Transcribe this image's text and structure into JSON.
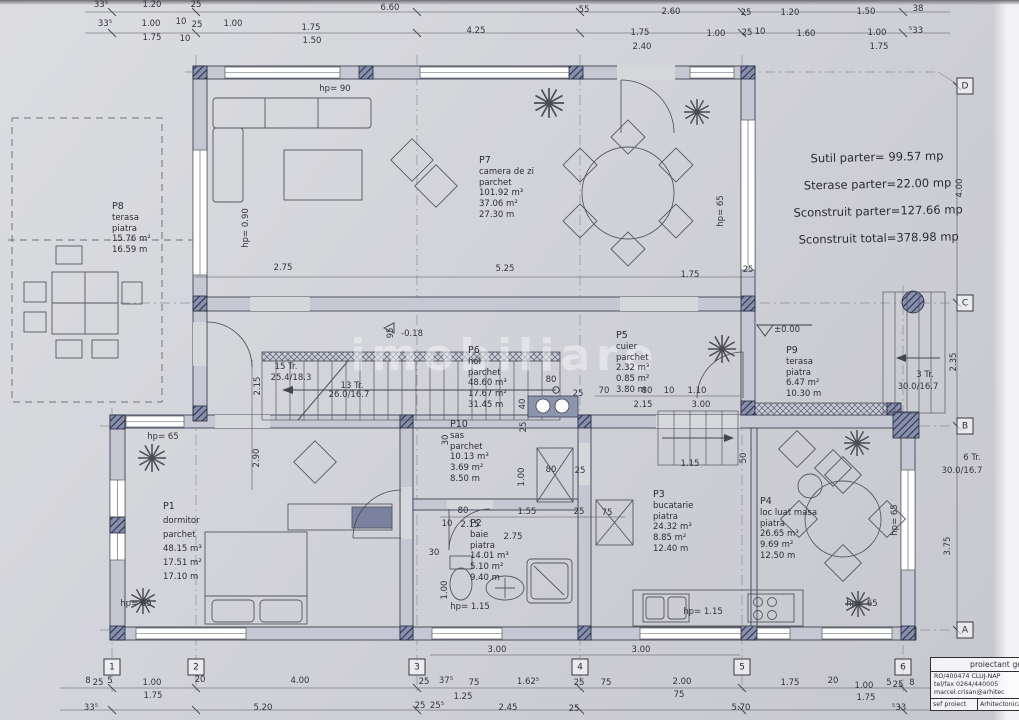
{
  "sheet": {
    "watermark": "imobiliare",
    "summary": [
      "Sutil parter= 99.57 mp",
      "Sterase parter=22.00 mp",
      "Sconstruit parter=127.66 mp",
      "Sconstruit total=378.98 mp"
    ],
    "title_block": {
      "header": "proiectant general",
      "line1": "RO/400474 CLUJ-NAP",
      "line2": "tel/fax 0264/440005",
      "line3": "marcel.crisan@arhitec",
      "row_label": "sef proiect",
      "row_value": "Arhitectonica"
    }
  },
  "rooms": [
    {
      "id": "P7",
      "name": "camera de zi",
      "finish": "parchet",
      "vals": [
        "101.92 m³",
        "37.06 m²",
        "27.30 m"
      ],
      "x": 479,
      "y": 156
    },
    {
      "id": "P8",
      "name": "terasa",
      "finish": "piatra",
      "vals": [
        "15.76 m²",
        "16.59 m"
      ],
      "x": 112,
      "y": 202
    },
    {
      "id": "P6",
      "name": "hol",
      "finish": "parchet",
      "vals": [
        "48.60 m³",
        "17.67 m²",
        "31.45 m"
      ],
      "x": 468,
      "y": 346
    },
    {
      "id": "P5",
      "name": "cuier",
      "finish": "parchet",
      "vals": [
        "2.32 m³",
        "0.85 m²",
        "3.80 m"
      ],
      "x": 616,
      "y": 331
    },
    {
      "id": "P9",
      "name": "terasa",
      "finish": "piatra",
      "vals": [
        "6.47 m²",
        "10.30 m"
      ],
      "x": 786,
      "y": 346
    },
    {
      "id": "P10",
      "name": "sas",
      "finish": "parchet",
      "vals": [
        "10.13 m³",
        "3.69 m²",
        "8.50 m"
      ],
      "x": 450,
      "y": 420
    },
    {
      "id": "P1",
      "name": "dormitor",
      "finish": "parchet",
      "vals": [
        "48.15 m³",
        "17.51 m²",
        "17.10 m"
      ],
      "x": 163,
      "y": 500,
      "lh": 14
    },
    {
      "id": "P2",
      "name": "baie",
      "finish": "piatra",
      "vals": [
        "14.01 m³",
        "5.10 m²",
        "9.40 m"
      ],
      "x": 470,
      "y": 519
    },
    {
      "id": "P3",
      "name": "bucatarie",
      "finish": "piatra",
      "vals": [
        "24.32 m³",
        "8.85 m²",
        "12.40 m"
      ],
      "x": 653,
      "y": 490
    },
    {
      "id": "P4",
      "name": "loc luat masa",
      "finish": "piatra",
      "vals": [
        "26.65 m³",
        "9.69 m²",
        "12.50 m"
      ],
      "x": 760,
      "y": 497
    }
  ],
  "grid": {
    "bottom": [
      {
        "n": "1",
        "x": 112
      },
      {
        "n": "2",
        "x": 196
      },
      {
        "n": "3",
        "x": 417
      },
      {
        "n": "4",
        "x": 580
      },
      {
        "n": "5",
        "x": 742
      },
      {
        "n": "6",
        "x": 903
      }
    ],
    "right": [
      {
        "n": "D",
        "y": 86
      },
      {
        "n": "C",
        "y": 303
      },
      {
        "n": "B",
        "y": 426
      },
      {
        "n": "A",
        "y": 630
      }
    ]
  },
  "labels": [
    {
      "t": "33⁵",
      "x": 101,
      "y": 5
    },
    {
      "t": "1.20",
      "x": 152,
      "y": 5
    },
    {
      "t": "25",
      "x": 196,
      "y": 5
    },
    {
      "t": "6.60",
      "x": 390,
      "y": 8
    },
    {
      "t": "55",
      "x": 584,
      "y": 10
    },
    {
      "t": "2.60",
      "x": 671,
      "y": 12
    },
    {
      "t": "25",
      "x": 746,
      "y": 13
    },
    {
      "t": "1.20",
      "x": 790,
      "y": 13
    },
    {
      "t": "1.50",
      "x": 866,
      "y": 12
    },
    {
      "t": "38",
      "x": 918,
      "y": 9
    },
    {
      "t": "33⁵",
      "x": 105,
      "y": 24
    },
    {
      "t": "1.00",
      "x": 151,
      "y": 24
    },
    {
      "t": "10",
      "x": 181,
      "y": 22
    },
    {
      "t": "25",
      "x": 197,
      "y": 25
    },
    {
      "t": "1.00",
      "x": 233,
      "y": 24
    },
    {
      "t": "1.75",
      "x": 311,
      "y": 28
    },
    {
      "t": "4.25",
      "x": 476,
      "y": 31
    },
    {
      "t": "1.75",
      "x": 640,
      "y": 33
    },
    {
      "t": "1.00",
      "x": 716,
      "y": 34
    },
    {
      "t": "25",
      "x": 747,
      "y": 33
    },
    {
      "t": "10",
      "x": 760,
      "y": 32
    },
    {
      "t": "1.60",
      "x": 806,
      "y": 34
    },
    {
      "t": "1.00",
      "x": 877,
      "y": 33
    },
    {
      "t": "⁵33",
      "x": 916,
      "y": 31
    },
    {
      "t": "1.75",
      "x": 152,
      "y": 38
    },
    {
      "t": "10",
      "x": 185,
      "y": 39
    },
    {
      "t": "1.50",
      "x": 312,
      "y": 41
    },
    {
      "t": "2.40",
      "x": 642,
      "y": 47
    },
    {
      "t": "1.75",
      "x": 879,
      "y": 47
    },
    {
      "t": "8",
      "x": 88,
      "y": 681
    },
    {
      "t": "25",
      "x": 98,
      "y": 683
    },
    {
      "t": "5",
      "x": 110,
      "y": 681
    },
    {
      "t": "1.00",
      "x": 152,
      "y": 683
    },
    {
      "t": "20",
      "x": 200,
      "y": 680
    },
    {
      "t": "4.00",
      "x": 300,
      "y": 681
    },
    {
      "t": "25",
      "x": 424,
      "y": 682
    },
    {
      "t": "37⁵",
      "x": 446,
      "y": 681
    },
    {
      "t": "75",
      "x": 474,
      "y": 683
    },
    {
      "t": "1.62⁵",
      "x": 528,
      "y": 682
    },
    {
      "t": "25",
      "x": 579,
      "y": 683
    },
    {
      "t": "75",
      "x": 606,
      "y": 683
    },
    {
      "t": "2.00",
      "x": 682,
      "y": 682
    },
    {
      "t": "1.75",
      "x": 790,
      "y": 683
    },
    {
      "t": "20",
      "x": 833,
      "y": 681
    },
    {
      "t": "1.00",
      "x": 864,
      "y": 686
    },
    {
      "t": "5",
      "x": 889,
      "y": 683
    },
    {
      "t": "25",
      "x": 898,
      "y": 685
    },
    {
      "t": "8",
      "x": 912,
      "y": 683
    },
    {
      "t": "1.75",
      "x": 153,
      "y": 696
    },
    {
      "t": "1.25",
      "x": 463,
      "y": 697
    },
    {
      "t": "75",
      "x": 679,
      "y": 695
    },
    {
      "t": "1.75",
      "x": 866,
      "y": 698
    },
    {
      "t": "33⁵",
      "x": 91,
      "y": 708
    },
    {
      "t": "5.20",
      "x": 263,
      "y": 708
    },
    {
      "t": "25",
      "x": 420,
      "y": 706
    },
    {
      "t": "25⁵",
      "x": 437,
      "y": 706
    },
    {
      "t": "2.45",
      "x": 508,
      "y": 708
    },
    {
      "t": "25",
      "x": 574,
      "y": 709
    },
    {
      "t": "5.70",
      "x": 741,
      "y": 708
    },
    {
      "t": "⁵33",
      "x": 899,
      "y": 708
    },
    {
      "t": "3.00",
      "x": 497,
      "y": 650
    },
    {
      "t": "3.00",
      "x": 641,
      "y": 650
    },
    {
      "t": "2.75",
      "x": 283,
      "y": 268
    },
    {
      "t": "5.25",
      "x": 505,
      "y": 269
    },
    {
      "t": "1.75",
      "x": 690,
      "y": 275
    },
    {
      "t": "25",
      "x": 748,
      "y": 270
    },
    {
      "t": "hp= 90",
      "x": 335,
      "y": 89
    },
    {
      "t": "hp= 0.90",
      "x": 246,
      "y": 228,
      "v": 1
    },
    {
      "t": "hp= 65",
      "x": 721,
      "y": 211,
      "v": 1
    },
    {
      "t": "hp= 65",
      "x": 163,
      "y": 437
    },
    {
      "t": "hp= 65",
      "x": 136,
      "y": 604
    },
    {
      "t": "hp= 65",
      "x": 862,
      "y": 604
    },
    {
      "t": "hp= 65",
      "x": 895,
      "y": 520,
      "v": 1
    },
    {
      "t": "hp= 1.15",
      "x": 470,
      "y": 607
    },
    {
      "t": "hp= 1.15",
      "x": 703,
      "y": 612
    },
    {
      "t": "80",
      "x": 551,
      "y": 380
    },
    {
      "t": "25",
      "x": 578,
      "y": 394
    },
    {
      "t": "70",
      "x": 604,
      "y": 391
    },
    {
      "t": "80",
      "x": 647,
      "y": 391
    },
    {
      "t": "10",
      "x": 669,
      "y": 391
    },
    {
      "t": "1.10",
      "x": 697,
      "y": 391
    },
    {
      "t": "2.15",
      "x": 643,
      "y": 405
    },
    {
      "t": "3.00",
      "x": 701,
      "y": 405
    },
    {
      "t": "40",
      "x": 523,
      "y": 404,
      "v": 1
    },
    {
      "t": "25",
      "x": 524,
      "y": 427,
      "v": 1
    },
    {
      "t": "30",
      "x": 446,
      "y": 440,
      "v": 1
    },
    {
      "t": "1.00",
      "x": 522,
      "y": 477,
      "v": 1
    },
    {
      "t": "80",
      "x": 551,
      "y": 470
    },
    {
      "t": "25",
      "x": 580,
      "y": 471
    },
    {
      "t": "80",
      "x": 463,
      "y": 511
    },
    {
      "t": "1.55",
      "x": 527,
      "y": 512
    },
    {
      "t": "25",
      "x": 579,
      "y": 512
    },
    {
      "t": "75",
      "x": 607,
      "y": 513
    },
    {
      "t": "10",
      "x": 447,
      "y": 524
    },
    {
      "t": "2.15",
      "x": 470,
      "y": 525
    },
    {
      "t": "2.75",
      "x": 513,
      "y": 537
    },
    {
      "t": "30",
      "x": 434,
      "y": 553
    },
    {
      "t": "1.00",
      "x": 445,
      "y": 590,
      "v": 1
    },
    {
      "t": "2.15",
      "x": 258,
      "y": 386,
      "v": 1
    },
    {
      "t": "2.90",
      "x": 257,
      "y": 458,
      "v": 1
    },
    {
      "t": "95",
      "x": 391,
      "y": 333,
      "v": 1
    },
    {
      "t": "1.15",
      "x": 690,
      "y": 464
    },
    {
      "t": "50",
      "x": 744,
      "y": 458,
      "v": 1
    },
    {
      "t": "4.00",
      "x": 960,
      "y": 188,
      "v": 1
    },
    {
      "t": "2.35",
      "x": 954,
      "y": 362,
      "v": 1
    },
    {
      "t": "3.75",
      "x": 948,
      "y": 546,
      "v": 1
    },
    {
      "t": "15 Tr.",
      "x": 286,
      "y": 367
    },
    {
      "t": "25.4/18.3",
      "x": 291,
      "y": 378
    },
    {
      "t": "13 Tr.",
      "x": 352,
      "y": 386
    },
    {
      "t": "26.0/16.7",
      "x": 349,
      "y": 395
    },
    {
      "t": "3 Tr.",
      "x": 925,
      "y": 375
    },
    {
      "t": "30.0/16.7",
      "x": 918,
      "y": 387
    },
    {
      "t": "6 Tr.",
      "x": 972,
      "y": 458
    },
    {
      "t": "30.0/16.7",
      "x": 962,
      "y": 471
    },
    {
      "t": "±0.00",
      "x": 787,
      "y": 330
    },
    {
      "t": "-0.18",
      "x": 412,
      "y": 334
    }
  ]
}
